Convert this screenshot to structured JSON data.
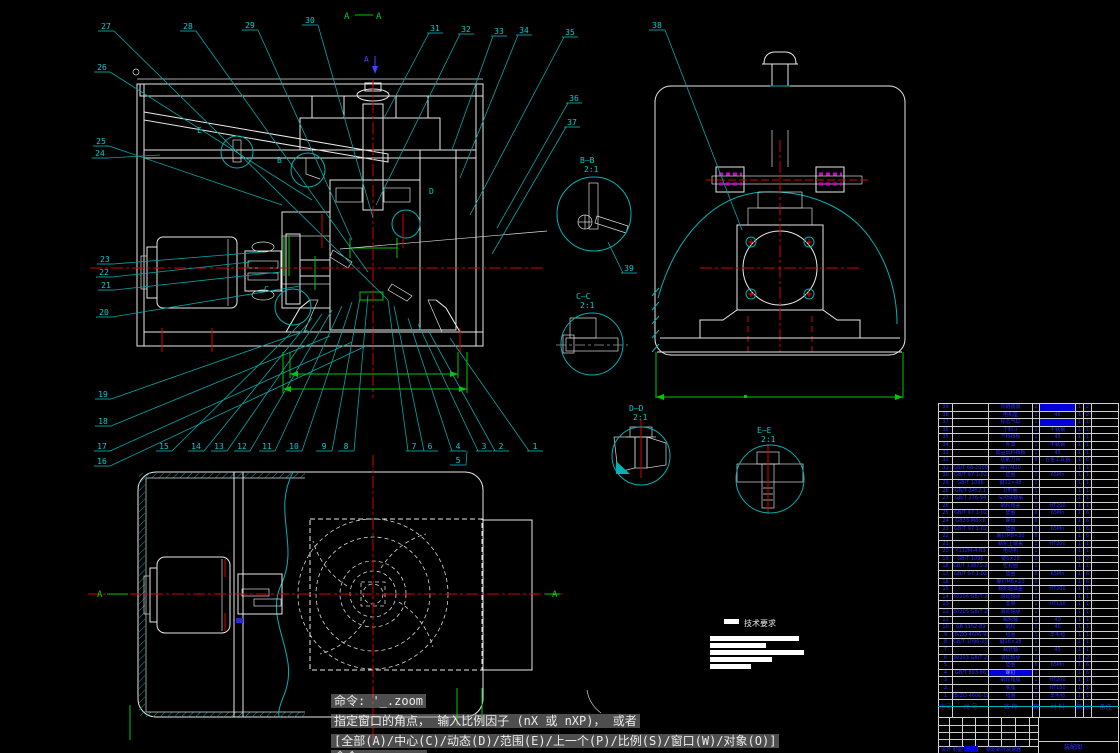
{
  "markers": {
    "a1": "A",
    "a2": "A",
    "arrow_a": "A",
    "plan_a_left": "A",
    "plan_a_right": "A"
  },
  "tech": {
    "title": "技术要求"
  },
  "command": {
    "line1": "命令: '_.zoom",
    "line2": "指定窗口的角点， 输入比例因子 (nX 或 nXP)， 或者",
    "line3": "[全部(A)/中心(C)/动态(D)/范围(E)/上一个(P)/比例(S)/窗口(W)/对象(O)]",
    "line4": "命令:"
  },
  "callouts": [
    {
      "n": "27",
      "x": 99,
      "y": 20,
      "tx": 388,
      "ty": 300
    },
    {
      "n": "28",
      "x": 181,
      "y": 20,
      "tx": 368,
      "ty": 272
    },
    {
      "n": "29",
      "x": 243,
      "y": 19,
      "tx": 352,
      "ty": 240
    },
    {
      "n": "30",
      "x": 303,
      "y": 14,
      "tx": 373,
      "ty": 218
    },
    {
      "n": "31",
      "x": 428,
      "y": 22,
      "tx": 384,
      "ty": 118
    },
    {
      "n": "32",
      "x": 459,
      "y": 23,
      "tx": 376,
      "ty": 205
    },
    {
      "n": "33",
      "x": 492,
      "y": 25,
      "tx": 452,
      "ty": 150
    },
    {
      "n": "34",
      "x": 517,
      "y": 24,
      "tx": 460,
      "ty": 178
    },
    {
      "n": "35",
      "x": 563,
      "y": 26,
      "tx": 470,
      "ty": 215
    },
    {
      "n": "38",
      "x": 650,
      "y": 19,
      "tx": 742,
      "ty": 230
    },
    {
      "n": "36",
      "x": 567,
      "y": 92,
      "tx": 497,
      "ty": 228
    },
    {
      "n": "37",
      "x": 565,
      "y": 116,
      "tx": 492,
      "ty": 254
    },
    {
      "n": "26",
      "x": 95,
      "y": 61,
      "tx": 312,
      "ty": 200
    },
    {
      "n": "25",
      "x": 94,
      "y": 135,
      "tx": 282,
      "ty": 205
    },
    {
      "n": "24",
      "x": 93,
      "y": 147,
      "tx": 160,
      "ty": 155
    },
    {
      "n": "23",
      "x": 98,
      "y": 253,
      "tx": 262,
      "ty": 252
    },
    {
      "n": "22",
      "x": 97,
      "y": 266,
      "tx": 250,
      "ty": 262
    },
    {
      "n": "21",
      "x": 99,
      "y": 279,
      "tx": 280,
      "ty": 272
    },
    {
      "n": "20",
      "x": 97,
      "y": 306,
      "tx": 300,
      "ty": 286
    },
    {
      "n": "19",
      "x": 96,
      "y": 388,
      "tx": 308,
      "ty": 330
    },
    {
      "n": "18",
      "x": 96,
      "y": 415,
      "tx": 330,
      "ty": 336
    },
    {
      "n": "17",
      "x": 95,
      "y": 440,
      "tx": 352,
      "ty": 342
    },
    {
      "n": "16",
      "x": 95,
      "y": 455,
      "tx": 366,
      "ty": 346
    },
    {
      "n": "15",
      "x": 157,
      "y": 440,
      "tx": 300,
      "ty": 324
    },
    {
      "n": "14",
      "x": 189,
      "y": 440,
      "tx": 312,
      "ty": 318
    },
    {
      "n": "13",
      "x": 212,
      "y": 440,
      "tx": 322,
      "ty": 314
    },
    {
      "n": "12",
      "x": 235,
      "y": 440,
      "tx": 332,
      "ty": 310
    },
    {
      "n": "11",
      "x": 260,
      "y": 440,
      "tx": 342,
      "ty": 306
    },
    {
      "n": "10",
      "x": 287,
      "y": 440,
      "tx": 352,
      "ty": 302
    },
    {
      "n": "9",
      "x": 317,
      "y": 440,
      "tx": 360,
      "ty": 298
    },
    {
      "n": "8",
      "x": 339,
      "y": 440,
      "tx": 368,
      "ty": 295
    },
    {
      "n": "7",
      "x": 407,
      "y": 440,
      "tx": 388,
      "ty": 300
    },
    {
      "n": "6",
      "x": 423,
      "y": 440,
      "tx": 394,
      "ty": 306
    },
    {
      "n": "4",
      "x": 451,
      "y": 440,
      "tx": 408,
      "ty": 318
    },
    {
      "n": "3",
      "x": 477,
      "y": 440,
      "tx": 418,
      "ty": 324
    },
    {
      "n": "2",
      "x": 494,
      "y": 440,
      "tx": 428,
      "ty": 330
    },
    {
      "n": "1",
      "x": 528,
      "y": 440,
      "tx": 450,
      "ty": 338
    },
    {
      "n": "5",
      "x": 451,
      "y": 454,
      "tx": 467,
      "ty": 451
    },
    {
      "n": "39",
      "x": 622,
      "y": 262,
      "tx": 608,
      "ty": 242
    }
  ],
  "letters": [
    {
      "t": "E",
      "x": 197,
      "y": 133
    },
    {
      "t": "B",
      "x": 277,
      "y": 163
    },
    {
      "t": "D",
      "x": 429,
      "y": 194
    },
    {
      "t": "C",
      "x": 264,
      "y": 292
    }
  ],
  "details": [
    {
      "label": "B—B",
      "scale": "2:1",
      "lx": 580,
      "ly": 156,
      "cx": 594,
      "cy": 214,
      "r": 37
    },
    {
      "label": "C—C",
      "scale": "2:1",
      "lx": 576,
      "ly": 292,
      "cx": 592,
      "cy": 344,
      "r": 31
    },
    {
      "label": "D—D",
      "scale": "2:1",
      "lx": 629,
      "ly": 404,
      "cx": 641,
      "cy": 456,
      "r": 29
    },
    {
      "label": "E—E",
      "scale": "2:1",
      "lx": 757,
      "ly": 426,
      "cx": 770,
      "cy": 479,
      "r": 34
    }
  ],
  "parts_table": {
    "headers": {
      "no": "序号",
      "code": "代 号",
      "name": "名 称",
      "qty": "数量",
      "mat": "材 料",
      "unit": "单件",
      "total": "总计",
      "note": "备注"
    },
    "title_block": {
      "credits": "设计 制图 审核",
      "name": "蜗轮蜗杆减速器",
      "right": "装配图"
    },
    "rows": [
      {
        "no": "39",
        "code": "",
        "name": "铰链装置",
        "qty": "2",
        "mat": "",
        "unit": "1",
        "total": "2",
        "note": "",
        "hl": "mat"
      },
      {
        "no": "38",
        "code": "",
        "name": "电机座",
        "qty": "1",
        "mat": "45",
        "unit": "1",
        "total": "2",
        "note": ""
      },
      {
        "no": "37",
        "code": "",
        "name": "标志气缸",
        "qty": "1",
        "mat": "",
        "unit": "1",
        "total": "1",
        "note": "",
        "hl": "mat"
      },
      {
        "no": "36",
        "code": "",
        "name": "下料斗",
        "qty": "1",
        "mat": "不锈钢",
        "unit": "1",
        "total": "1",
        "note": ""
      },
      {
        "no": "35",
        "code": "",
        "name": "下料挡板",
        "qty": "1",
        "mat": "45",
        "unit": "1",
        "total": "1",
        "note": ""
      },
      {
        "no": "34",
        "code": "",
        "name": "外罩",
        "qty": "1",
        "mat": "不锈钢",
        "unit": "1",
        "total": "1",
        "note": ""
      },
      {
        "no": "33",
        "code": "",
        "name": "成品出料挡板",
        "qty": "1",
        "mat": "45",
        "unit": "1",
        "total": "1",
        "note": ""
      },
      {
        "no": "32",
        "code": "",
        "name": "切削刀片",
        "qty": "8",
        "mat": "合金工具钢",
        "unit": "1",
        "total": "8",
        "note": ""
      },
      {
        "no": "31",
        "code": "GB/T 68-2000",
        "name": "螺钉M30",
        "qty": "1",
        "mat": "",
        "unit": "1",
        "total": "1",
        "note": ""
      },
      {
        "no": "30",
        "code": "GB/T 97.1-02",
        "name": "垫圈",
        "qty": "1",
        "mat": "65Mn",
        "unit": "1",
        "total": "1",
        "note": ""
      },
      {
        "no": "29",
        "code": "GB/T 1096",
        "name": "键12×48",
        "qty": "1",
        "mat": "",
        "unit": "1",
        "total": "1",
        "note": ""
      },
      {
        "no": "28",
        "code": "GB/T 3452.1",
        "name": "O形圈",
        "qty": "1",
        "mat": "",
        "unit": "1",
        "total": "1",
        "note": ""
      },
      {
        "no": "27",
        "code": "GB/T 276-94",
        "name": "深沟球轴承",
        "qty": "1",
        "mat": "",
        "unit": "1",
        "total": "1",
        "note": ""
      },
      {
        "no": "26",
        "code": "",
        "name": "蜗轮箱盖",
        "qty": "1",
        "mat": "HT200",
        "unit": "1",
        "total": "1",
        "note": ""
      },
      {
        "no": "25",
        "code": "GB/T 97.1-02",
        "name": "垫圈",
        "qty": "6",
        "mat": "65Mn",
        "unit": "1",
        "total": "6",
        "note": ""
      },
      {
        "no": "24",
        "code": "GB33-M8×6",
        "name": "螺母",
        "qty": "6",
        "mat": "",
        "unit": "1",
        "total": "6",
        "note": ""
      },
      {
        "no": "23",
        "code": "GB/T 97.1-02",
        "name": "垫圈",
        "qty": "6",
        "mat": "65Mn",
        "unit": "1",
        "total": "6",
        "note": ""
      },
      {
        "no": "22",
        "code": "",
        "name": "螺钉M8×30",
        "qty": "6",
        "mat": "",
        "unit": "1",
        "total": "6",
        "note": ""
      },
      {
        "no": "21",
        "code": "",
        "name": "蜗轮上端盖",
        "qty": "1",
        "mat": "HT200",
        "unit": "1",
        "total": "1",
        "note": ""
      },
      {
        "no": "20",
        "code": "Y112M-4-B3",
        "name": "电动机",
        "qty": "1",
        "mat": "",
        "unit": "1",
        "total": "1",
        "note": ""
      },
      {
        "no": "19",
        "code": "GB/T 1096",
        "name": "键6×28",
        "qty": "2",
        "mat": "",
        "unit": "1",
        "total": "2",
        "note": ""
      },
      {
        "no": "18",
        "code": "GB/T 13871-92",
        "name": "密封圈",
        "qty": "1",
        "mat": "",
        "unit": "1",
        "total": "1",
        "note": ""
      },
      {
        "no": "17",
        "code": "GB/T 97.1-02",
        "name": "垫圈",
        "qty": "6",
        "mat": "65Mn",
        "unit": "1",
        "total": "6",
        "note": ""
      },
      {
        "no": "16",
        "code": "",
        "name": "螺钉M6×20",
        "qty": "6",
        "mat": "",
        "unit": "1",
        "total": "6",
        "note": ""
      },
      {
        "no": "15",
        "code": "",
        "name": "蜗轮轴端盖",
        "qty": "1",
        "mat": "HT200",
        "unit": "1",
        "total": "1",
        "note": ""
      },
      {
        "no": "14",
        "code": "30206 GB/T 297-94",
        "name": "滚动轴承",
        "qty": "1",
        "mat": "",
        "unit": "1",
        "total": "1",
        "note": ""
      },
      {
        "no": "13",
        "code": "",
        "name": "支架",
        "qty": "1",
        "mat": "HT150",
        "unit": "1",
        "total": "1",
        "note": ""
      },
      {
        "no": "12",
        "code": "30205 GB/T 297-94",
        "name": "滚动轴承",
        "qty": "1",
        "mat": "",
        "unit": "1",
        "total": "1",
        "note": ""
      },
      {
        "no": "11",
        "code": "",
        "name": "蜗轮轴",
        "qty": "1",
        "mat": "40",
        "unit": "1",
        "total": "1",
        "note": ""
      },
      {
        "no": "10",
        "code": "GB 1152-89",
        "name": "蜗轮",
        "qty": "1",
        "mat": "40",
        "unit": "1",
        "total": "1",
        "note": ""
      },
      {
        "no": "9",
        "code": "JB/ZQ 4606-97",
        "name": "毡圈",
        "qty": "1",
        "mat": "羊毛毡",
        "unit": "1",
        "total": "1",
        "note": ""
      },
      {
        "no": "8",
        "code": "GB/T 1096-2003",
        "name": "键16×28",
        "qty": "1",
        "mat": "",
        "unit": "1",
        "total": "1",
        "note": ""
      },
      {
        "no": "7",
        "code": "",
        "name": "蜗杆轴",
        "qty": "1",
        "mat": "45",
        "unit": "1",
        "total": "1",
        "note": ""
      },
      {
        "no": "6",
        "code": "30203 GB/T 297-94",
        "name": "滚动轴承",
        "qty": "2",
        "mat": "",
        "unit": "1",
        "total": "2",
        "note": ""
      },
      {
        "no": "5",
        "code": "",
        "name": "垫圈",
        "qty": "6",
        "mat": "65Mn",
        "unit": "1",
        "total": "6",
        "note": ""
      },
      {
        "no": "4",
        "code": "GB/T 893-86",
        "name": "螺钉",
        "qty": "1",
        "mat": "",
        "unit": "1",
        "total": "6",
        "note": "",
        "hl": "name"
      },
      {
        "no": "3",
        "code": "",
        "name": "蜗轮箱座",
        "qty": "1",
        "mat": "HT200",
        "unit": "1",
        "total": "1",
        "note": ""
      },
      {
        "no": "2",
        "code": "",
        "name": "底座",
        "qty": "1",
        "mat": "HT150",
        "unit": "1",
        "total": "1",
        "note": ""
      },
      {
        "no": "1",
        "code": "JB/ZQ 4606-1997",
        "name": "毡圈",
        "qty": "1",
        "mat": "羊毛毡",
        "unit": "1",
        "total": "1",
        "note": ""
      }
    ]
  },
  "colors": {
    "cyan": "#00b2b2",
    "red": "#d40000",
    "green": "#00c800",
    "table_text": "#2b2bff",
    "magenta": "#d000d0",
    "white": "#e9e9e9"
  }
}
